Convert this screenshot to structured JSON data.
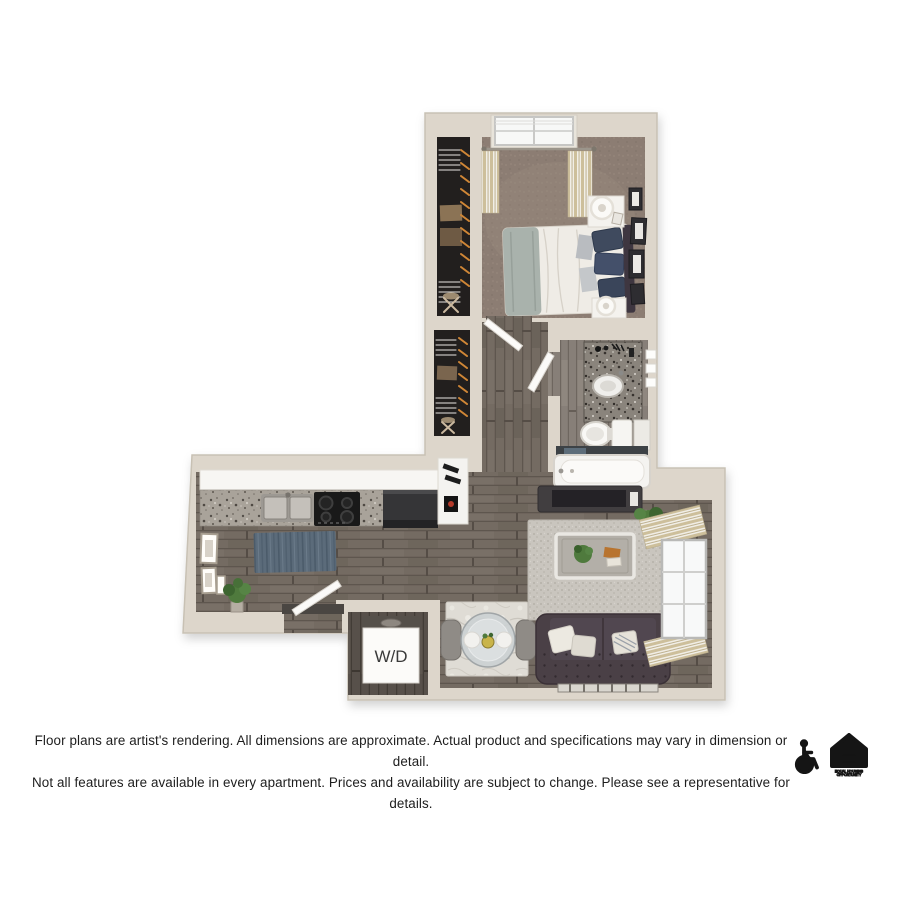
{
  "floor_plan": {
    "wd_label": "W/D"
  },
  "disclaimer": {
    "line1": "Floor plans are artist's rendering. All dimensions are approximate. Actual product and specifications may vary in dimension or detail.",
    "line2": "Not all features are available in every apartment. Prices and availability are subject to change. Please see a representative for details."
  },
  "icons": {
    "eho_line1": "EQUAL HOUSING",
    "eho_line2": "OPPORTUNITY"
  },
  "colors": {
    "background": "#ffffff",
    "text": "#1d1d1d",
    "wall": "#ddd6cb",
    "wall_edge": "#c8c1b4",
    "wood_floor": "#746b62",
    "wood_floor_dark": "#57504a",
    "carpet": "#8c7d73",
    "closet_interior": "#221f1e",
    "granite_counter": "#a9a39a",
    "vanity_granite": "#8a847c",
    "rug_blue": "#5b6b7a",
    "rug_living": "#c9c5be",
    "rug_dining": "#dfdcd5",
    "sofa": "#4a4046",
    "curtain_stripe": "#cdbf9b",
    "icon_black": "#151515"
  }
}
